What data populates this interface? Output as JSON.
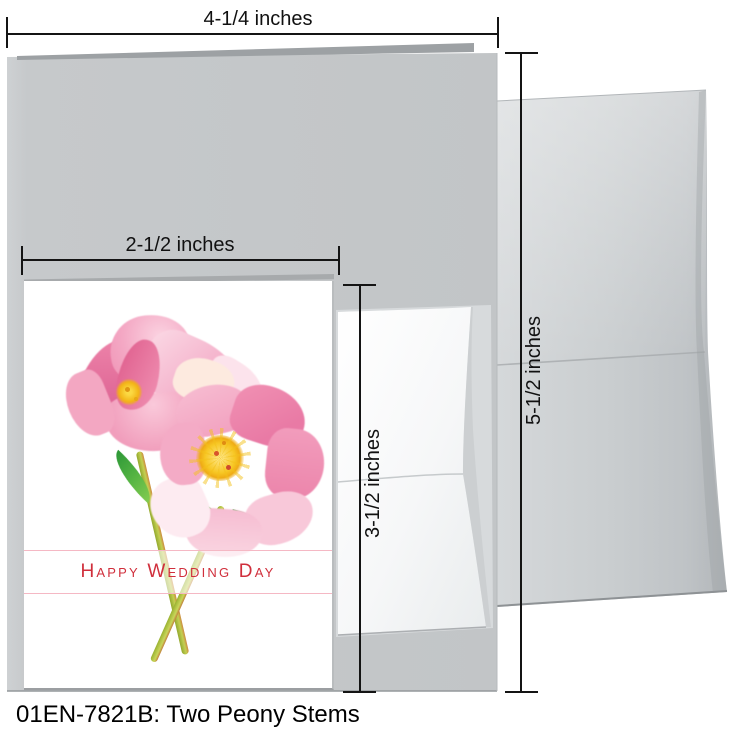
{
  "product": {
    "caption": "01EN-7821B: Two Peony Stems",
    "card_greeting": "Happy Wedding Day"
  },
  "dimensions": {
    "large_card_width": "4-1/4 inches",
    "large_card_height": "5-1/2 inches",
    "small_card_width": "2-1/2 inches",
    "small_card_height": "3-1/2 inches"
  },
  "colors": {
    "greeting_red": "#d02f3c",
    "banner_pink": "#f5b8c4",
    "petal_pink": "#f2a0bf",
    "petal_deep_pink": "#e0618f",
    "stamen_yellow": "#f2b214",
    "leaf_green": "#33a03c",
    "stem_olive": "#a9ba35",
    "card_gray": "#c3c6c8",
    "envelope_gray": "#c9cdcf",
    "annotation_black": "#141414"
  }
}
